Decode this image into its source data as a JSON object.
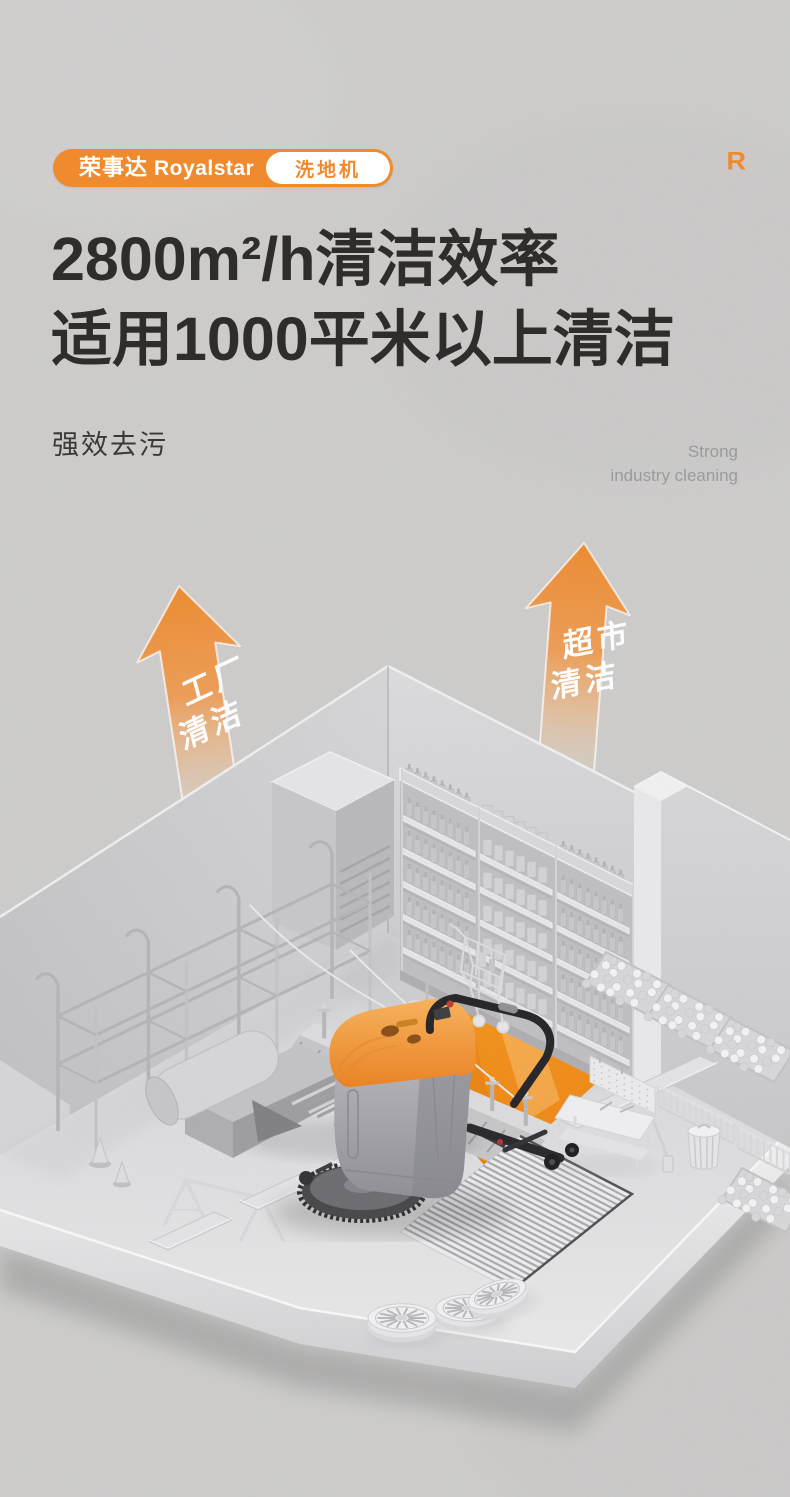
{
  "brand": {
    "logo_cn": "荣事达",
    "logo_en": "Royalstar",
    "tag": "洗地机",
    "corner_mark": "R"
  },
  "headline": {
    "line1": "2800m²/h清洁效率",
    "line2": "适用1000平米以上清洁"
  },
  "subheading": {
    "cn": "强效去污",
    "en_line1": "Strong",
    "en_line2": "industry cleaning"
  },
  "arrows": {
    "left": {
      "top": "工厂",
      "bottom": "清洁"
    },
    "right": {
      "top": "超市",
      "bottom": "清洁"
    }
  },
  "colors": {
    "accent": "#F08A2E",
    "path_orange": "#F1911E",
    "headline": "#2E2D2B",
    "muted": "#9B9B9B",
    "background": "#CDCCCB"
  }
}
